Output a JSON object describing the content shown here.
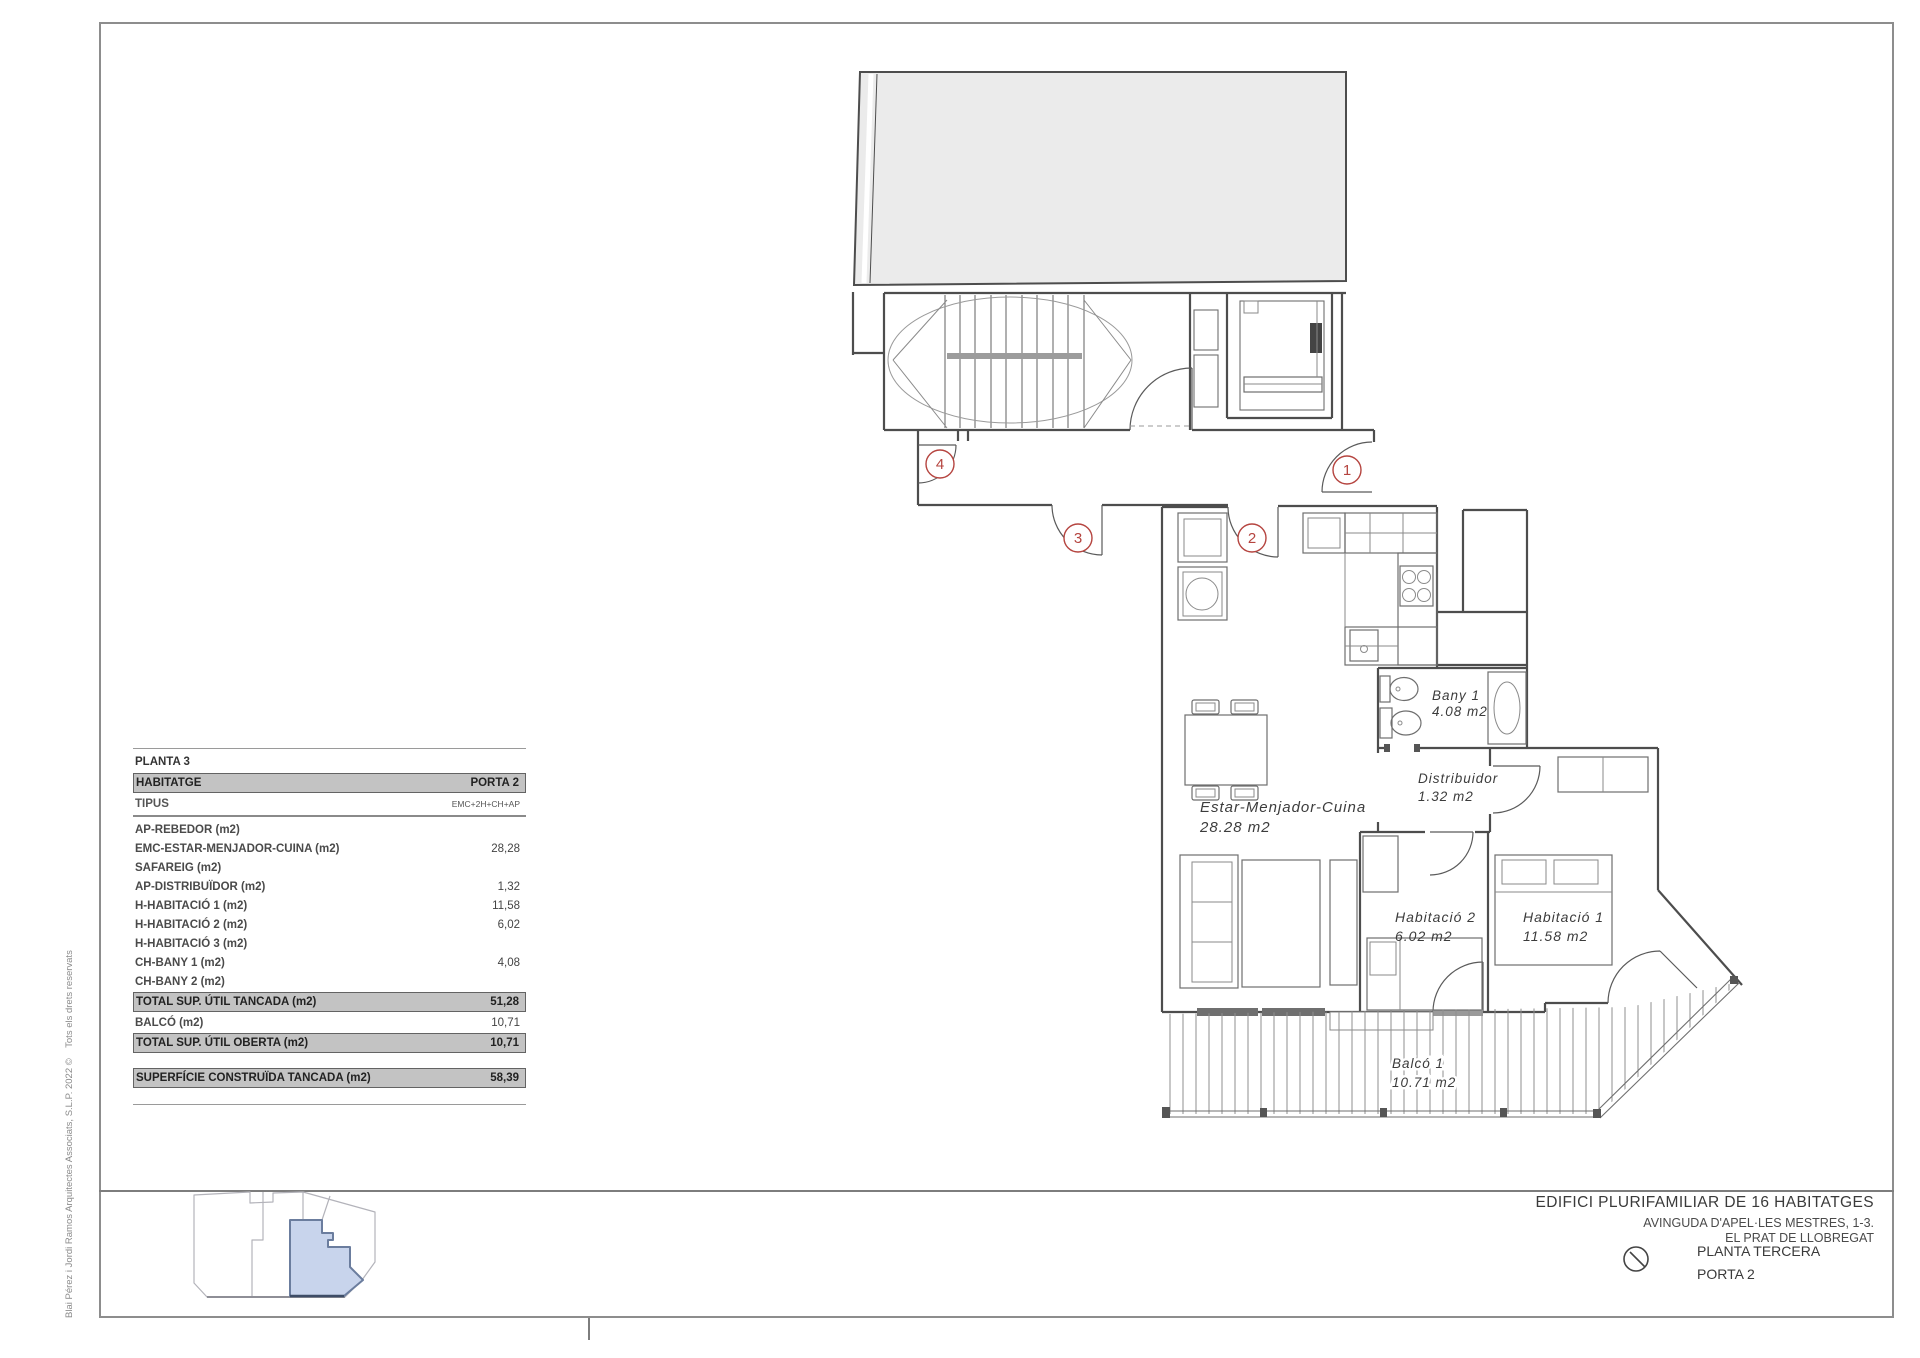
{
  "sheet": {
    "copyright": "Blai Pérez i Jordi Ramos Arquitectes Associats, S.L.P. 2022 ©    Tots els drets reservats"
  },
  "table": {
    "floor_header": "PLANTA 3",
    "rows": [
      {
        "label": "HABITATGE",
        "value": "PORTA 2"
      },
      {
        "label": "TIPUS",
        "value": "EMC+2H+CH+AP"
      },
      {
        "label": "AP-REBEDOR (m2)",
        "value": ""
      },
      {
        "label": "EMC-ESTAR-MENJADOR-CUINA (m2)",
        "value": "28,28"
      },
      {
        "label": "SAFAREIG (m2)",
        "value": ""
      },
      {
        "label": "AP-DISTRIBUÏDOR (m2)",
        "value": "1,32"
      },
      {
        "label": "H-HABITACIÓ 1 (m2)",
        "value": "11,58"
      },
      {
        "label": "H-HABITACIÓ 2 (m2)",
        "value": "6,02"
      },
      {
        "label": "H-HABITACIÓ 3 (m2)",
        "value": ""
      },
      {
        "label": "CH-BANY 1 (m2)",
        "value": "4,08"
      },
      {
        "label": "CH-BANY 2 (m2)",
        "value": ""
      },
      {
        "label": "TOTAL SUP. ÚTIL TANCADA (m2)",
        "value": "51,28"
      },
      {
        "label": "BALCÓ  (m2)",
        "value": "10,71"
      },
      {
        "label": "TOTAL SUP. ÚTIL OBERTA (m2)",
        "value": "10,71"
      },
      {
        "label": "SUPERFÍCIE CONSTRUÏDA TANCADA (m2)",
        "value": "58,39"
      }
    ]
  },
  "plan": {
    "rooms": [
      {
        "name": "Bany 1",
        "area": "4.08 m2"
      },
      {
        "name": "Distribuidor",
        "area": "1.32 m2"
      },
      {
        "name": "Estar-Menjador-Cuina",
        "area": "28.28 m2"
      },
      {
        "name": "Habitació 2",
        "area": "6.02 m2"
      },
      {
        "name": "Habitació 1",
        "area": "11.58 m2"
      },
      {
        "name": "Balcó 1",
        "area": "10.71 m2"
      }
    ],
    "door_numbers": [
      "1",
      "2",
      "3",
      "4"
    ]
  },
  "title_block": {
    "project": "EDIFICI PLURIFAMILIAR DE 16 HABITATGES",
    "address_line1": "AVINGUDA D'APEL·LES MESTRES, 1-3.",
    "address_line2": "EL PRAT DE LLOBREGAT",
    "plan_name": "PLANTA TERCERA",
    "unit": "PORTA 2"
  },
  "colors": {
    "accent_red": "#b5443f",
    "roof_gray": "#ebebeb",
    "bar_gray": "#c3c3c3",
    "keyplan_highlight": "#c8d4ec"
  }
}
